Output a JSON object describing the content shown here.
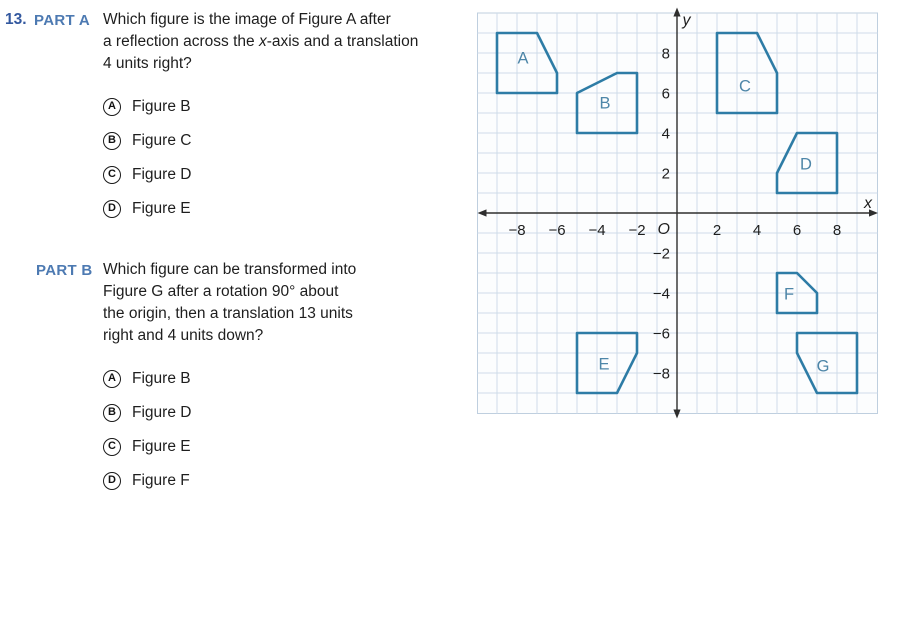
{
  "question": {
    "number": "13.",
    "part_a": {
      "label": "PART A",
      "lines": [
        "Which figure is the image of Figure A after",
        "a reflection across the <i>x</i>-axis and a translation",
        "4 units right?"
      ],
      "options": [
        {
          "letter": "A",
          "label": "Figure B"
        },
        {
          "letter": "B",
          "label": "Figure C"
        },
        {
          "letter": "C",
          "label": "Figure D"
        },
        {
          "letter": "D",
          "label": "Figure E"
        }
      ]
    },
    "part_b": {
      "label": "PART B",
      "lines": [
        "Which figure can be transformed into",
        "Figure G after a rotation 90° about",
        "the origin, then a translation 13 units",
        "right and 4 units down?"
      ],
      "options": [
        {
          "letter": "A",
          "label": "Figure B"
        },
        {
          "letter": "B",
          "label": "Figure D"
        },
        {
          "letter": "C",
          "label": "Figure E"
        },
        {
          "letter": "D",
          "label": "Figure F"
        }
      ]
    }
  },
  "graph": {
    "type": "coordinate-plane",
    "x_label": "x",
    "y_label": "y",
    "origin_label": "O",
    "x_range": [
      -10,
      10
    ],
    "y_range": [
      -10,
      10
    ],
    "grid_unit_px": 20,
    "x_ticks": [
      {
        "v": -8,
        "label": "−8"
      },
      {
        "v": -6,
        "label": "−6"
      },
      {
        "v": -4,
        "label": "−4"
      },
      {
        "v": -2,
        "label": "−2"
      },
      {
        "v": 2,
        "label": "2"
      },
      {
        "v": 4,
        "label": "4"
      },
      {
        "v": 6,
        "label": "6"
      },
      {
        "v": 8,
        "label": "8"
      }
    ],
    "y_ticks": [
      {
        "v": 8,
        "label": "8"
      },
      {
        "v": 6,
        "label": "6"
      },
      {
        "v": 4,
        "label": "4"
      },
      {
        "v": 2,
        "label": "2"
      },
      {
        "v": -2,
        "label": "−2"
      },
      {
        "v": -4,
        "label": "−4"
      },
      {
        "v": -6,
        "label": "−6"
      },
      {
        "v": -8,
        "label": "−8"
      }
    ],
    "figures": [
      {
        "name": "A",
        "vertices": [
          [
            -9,
            9
          ],
          [
            -7,
            9
          ],
          [
            -6,
            7
          ],
          [
            -6,
            6
          ],
          [
            -9,
            6
          ]
        ],
        "label_pos": [
          -7.7,
          7.75
        ]
      },
      {
        "name": "B",
        "vertices": [
          [
            -5,
            6
          ],
          [
            -3,
            7
          ],
          [
            -2,
            7
          ],
          [
            -2,
            4
          ],
          [
            -5,
            4
          ]
        ],
        "label_pos": [
          -3.6,
          5.5
        ]
      },
      {
        "name": "C",
        "vertices": [
          [
            2,
            9
          ],
          [
            4,
            9
          ],
          [
            5,
            7
          ],
          [
            5,
            5
          ],
          [
            2,
            5
          ]
        ],
        "label_pos": [
          3.4,
          6.35
        ]
      },
      {
        "name": "D",
        "vertices": [
          [
            6,
            4
          ],
          [
            8,
            4
          ],
          [
            8,
            1
          ],
          [
            5,
            1
          ],
          [
            5,
            2
          ]
        ],
        "label_pos": [
          6.45,
          2.45
        ]
      },
      {
        "name": "E",
        "vertices": [
          [
            -5,
            -6
          ],
          [
            -2,
            -6
          ],
          [
            -2,
            -7
          ],
          [
            -3,
            -9
          ],
          [
            -5,
            -9
          ]
        ],
        "label_pos": [
          -3.65,
          -7.55
        ]
      },
      {
        "name": "F",
        "vertices": [
          [
            5,
            -3
          ],
          [
            6,
            -3
          ],
          [
            7,
            -4
          ],
          [
            7,
            -5
          ],
          [
            5,
            -5
          ]
        ],
        "label_pos": [
          5.6,
          -4.05
        ]
      },
      {
        "name": "G",
        "vertices": [
          [
            6,
            -6
          ],
          [
            9,
            -6
          ],
          [
            9,
            -9
          ],
          [
            7,
            -9
          ],
          [
            6,
            -7
          ]
        ],
        "label_pos": [
          7.3,
          -7.65
        ]
      }
    ],
    "colors": {
      "figure_stroke": "#2e7ca6",
      "figure_label": "#4e86a8",
      "grid_line": "#cfdce9",
      "grid_border": "#bfcfdf",
      "grid_bg": "#fcfdfe",
      "axis": "#2e2e2e",
      "tick_text": "#1e1e1e",
      "part_label": "#4d7ab2",
      "question_number": "#33589f"
    }
  }
}
